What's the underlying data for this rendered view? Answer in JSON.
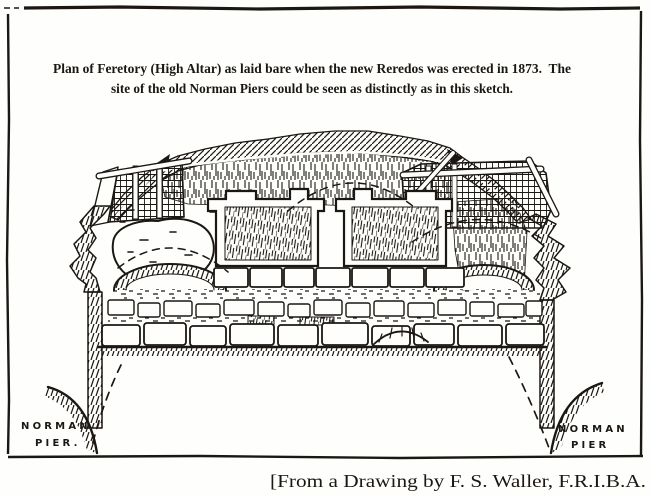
{
  "page": {
    "type": "scanned book plate, architectural plan etching",
    "colors": {
      "ink": "#1b1713",
      "paper": "#fefefc"
    }
  },
  "caption": {
    "line1": "Plan of Feretory (High Altar) as laid bare when the new Reredos was erected in 1873.  The",
    "line2": "site of the old Norman Piers could be seen as distinctly as in this sketch."
  },
  "plan_labels": {
    "left_pier": {
      "line1": "NORMAN",
      "line2": "PIER."
    },
    "right_pier": {
      "line1": "NORMAN",
      "line2": "PIER"
    }
  },
  "attribution": "[From a Drawing by F. S. Waller, F.R.I.B.A."
}
